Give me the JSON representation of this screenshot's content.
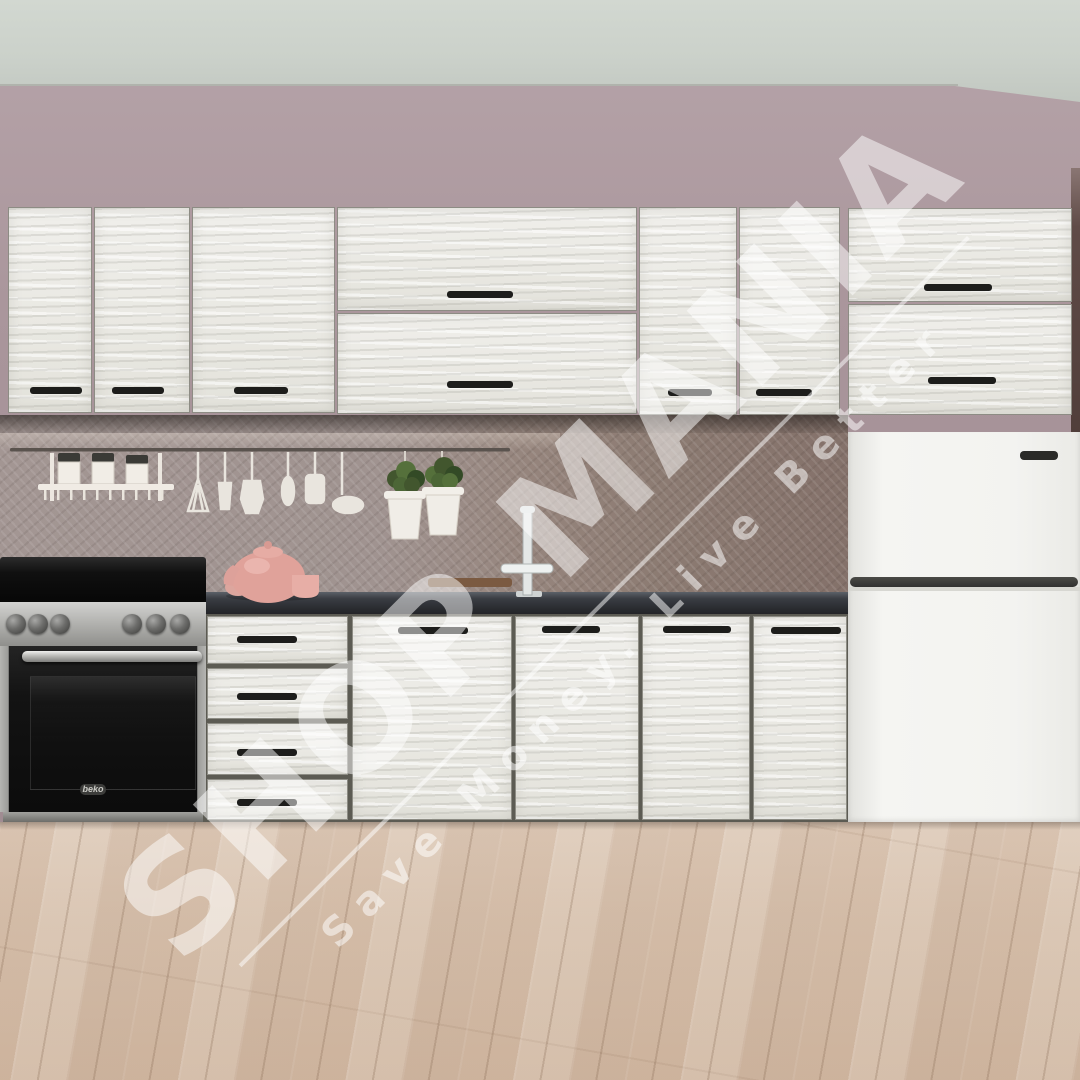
{
  "scene_title": "Kitchen furniture set product photo",
  "watermark": {
    "title": "SHOP MANIA",
    "tagline": "Save Money. Live Better",
    "color": "#ffffff"
  },
  "appliances": {
    "oven_brand_label": "beko"
  },
  "palette": {
    "ceiling": "#cbd1ca",
    "wall": "#aa969c",
    "cabinet_front": "#ebeae5",
    "cabinet_handle": "#1d1d1b",
    "countertop": "#34373c",
    "backsplash_left": "#a09390",
    "backsplash_right": "#8c7b72",
    "fridge": "#f2f2ef",
    "stove_black": "#141414",
    "stainless": "#b9b9b6",
    "floor_wood": "#d5c0ad",
    "plant_green": "#4c6636",
    "teapot_pink": "#e0a29a",
    "cutting_board": "#7b5a41"
  }
}
